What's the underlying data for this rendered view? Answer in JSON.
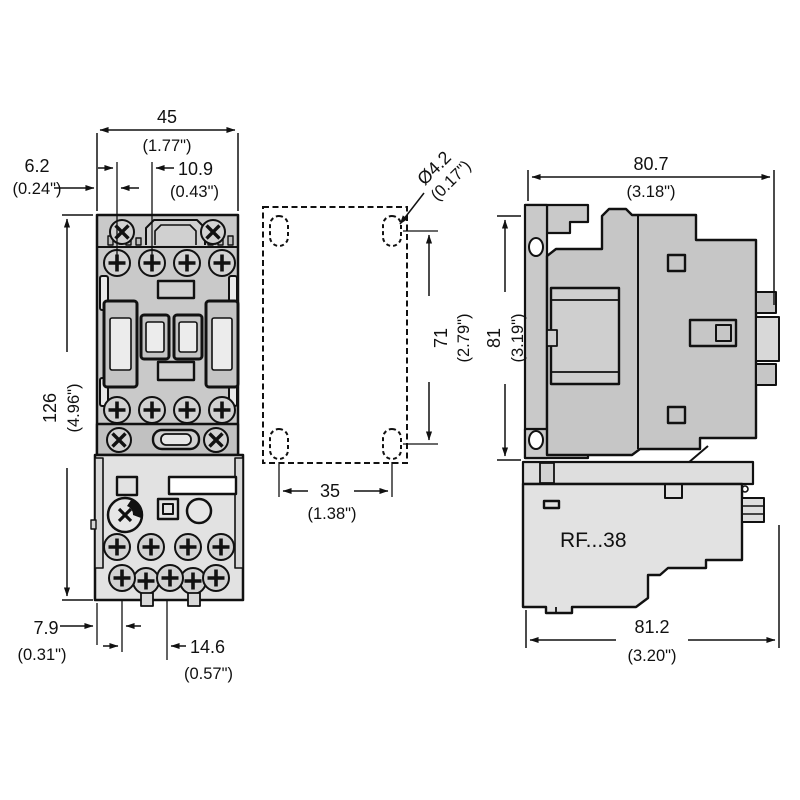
{
  "front_view": {
    "width": {
      "mm": "45",
      "inch": "(1.77\")"
    },
    "height": {
      "mm": "126",
      "inch": "(4.96\")"
    },
    "screw_offset": {
      "mm": "6.2",
      "inch": "(0.24\")"
    },
    "screw_pitch_top": {
      "mm": "10.9",
      "inch": "(0.43\")"
    },
    "bottom_offset": {
      "mm": "7.9",
      "inch": "(0.31\")"
    },
    "bottom_pitch": {
      "mm": "14.6",
      "inch": "(0.57\")"
    }
  },
  "mounting_pattern": {
    "hole_diameter": {
      "mm": "Ø4.2",
      "inch": "(0.17\")"
    },
    "vertical_pitch": {
      "mm": "71",
      "inch": "(2.79\")"
    },
    "horizontal_pitch": {
      "mm": "35",
      "inch": "(1.38\")"
    }
  },
  "side_view": {
    "depth_top": {
      "mm": "80.7",
      "inch": "(3.18\")"
    },
    "height": {
      "mm": "81",
      "inch": "(3.19\")"
    },
    "depth_bottom": {
      "mm": "81.2",
      "inch": "(3.20\")"
    },
    "relay_label": "RF...38"
  },
  "colors": {
    "body_gray": "#c9c9c9",
    "relay_gray": "#e2e2e2",
    "line": "#111111",
    "background": "#ffffff"
  }
}
